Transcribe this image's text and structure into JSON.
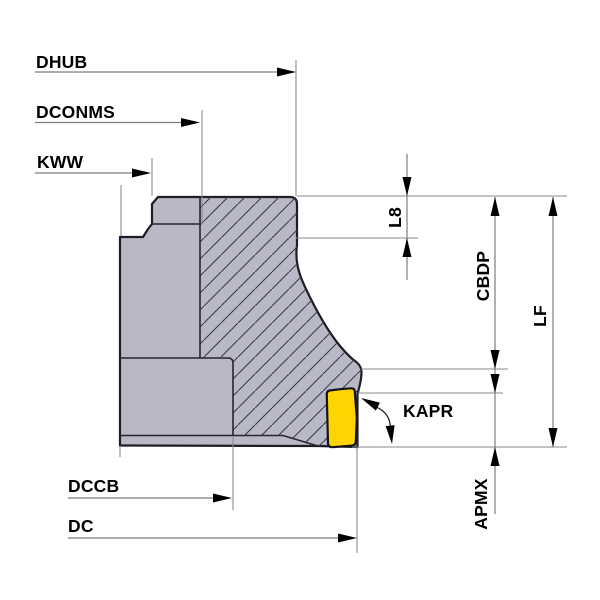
{
  "diagram": {
    "kind": "technical-drawing",
    "subject": "indexable face mill cutter cross-section with insert",
    "dimension_labels": {
      "dhub": "DHUB",
      "dconms": "DCONMS",
      "kww": "KWW",
      "l8": "L8",
      "cbdp": "CBDP",
      "lf": "LF",
      "kapr": "KAPR",
      "apmx": "APMX",
      "dccb": "DCCB",
      "dc": "DC"
    },
    "colors": {
      "background": "#ffffff",
      "body_fill": "#b8b8c6",
      "body_outline": "#1d1d24",
      "hatch_line": "#3c3c50",
      "insert_fill": "#ffd400",
      "insert_outline": "#141414",
      "dimension_line": "#7d7d7d",
      "arrow": "#000000",
      "text": "#000000"
    }
  }
}
